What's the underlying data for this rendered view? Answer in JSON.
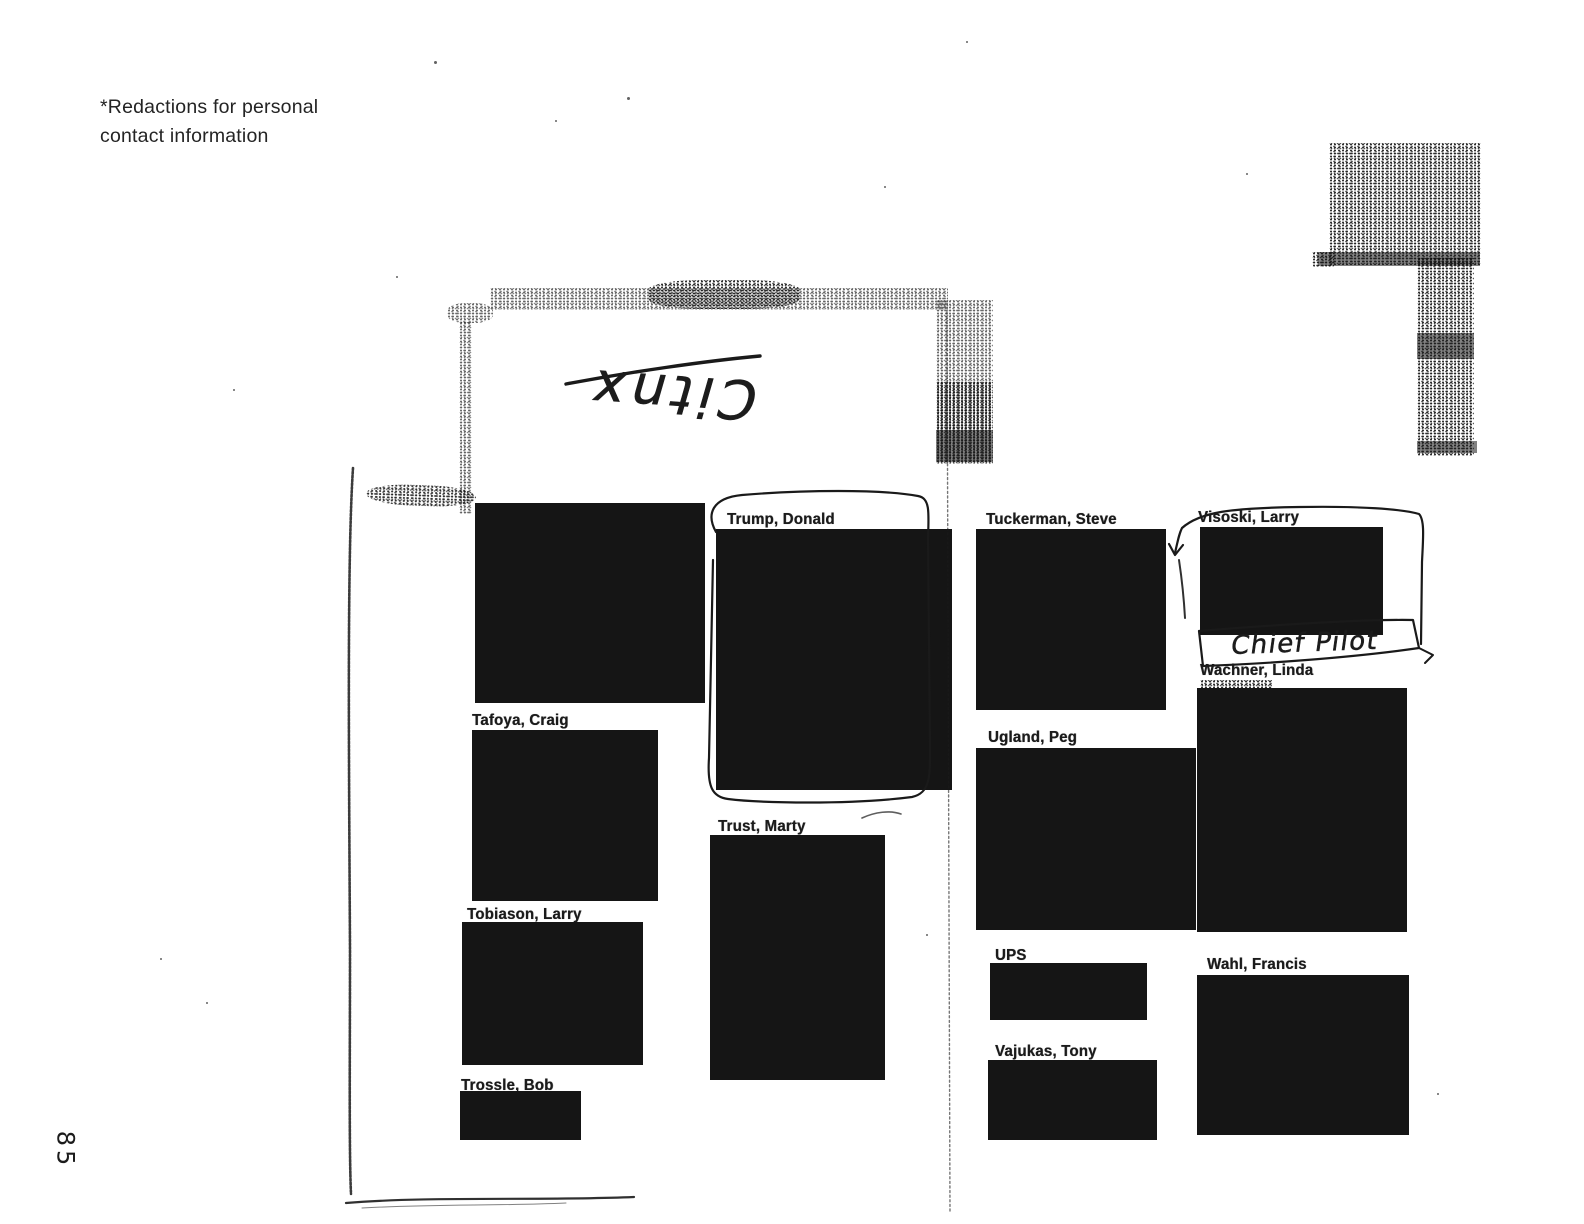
{
  "document": {
    "note": "*Redactions for personal\ncontact information",
    "page_number": "85"
  },
  "handwriting": {
    "flap_text": "Citnx",
    "flap_text_orientation": "upside-down",
    "annotation": "Chief Pilot"
  },
  "colors": {
    "paper": "#ffffff",
    "ink": "#1f1f1f",
    "redaction": "#151515"
  },
  "directory": {
    "left_page": {
      "columns": [
        {
          "entries": [
            {
              "name": "",
              "redacted": true
            },
            {
              "name": "Tafoya, Craig",
              "redacted": true
            },
            {
              "name": "Tobiason, Larry",
              "redacted": true
            },
            {
              "name": "Trossle, Bob",
              "redacted": true
            }
          ]
        },
        {
          "entries": [
            {
              "name": "Trump, Donald",
              "redacted": true,
              "marked": "hand-drawn circle"
            },
            {
              "name": "Trust, Marty",
              "redacted": true
            }
          ]
        }
      ]
    },
    "right_page": {
      "columns": [
        {
          "entries": [
            {
              "name": "Tuckerman, Steve",
              "redacted": true
            },
            {
              "name": "Ugland, Peg",
              "redacted": true
            },
            {
              "name": "UPS",
              "redacted": true
            },
            {
              "name": "Vajukas, Tony",
              "redacted": true
            }
          ]
        },
        {
          "entries": [
            {
              "name": "Visoski, Larry",
              "redacted": true,
              "marked": "hand-drawn box",
              "annotation": "Chief Pilot"
            },
            {
              "name": "Wachner, Linda",
              "redacted": true
            },
            {
              "name": "Wahl, Francis",
              "redacted": true
            }
          ]
        }
      ]
    }
  }
}
